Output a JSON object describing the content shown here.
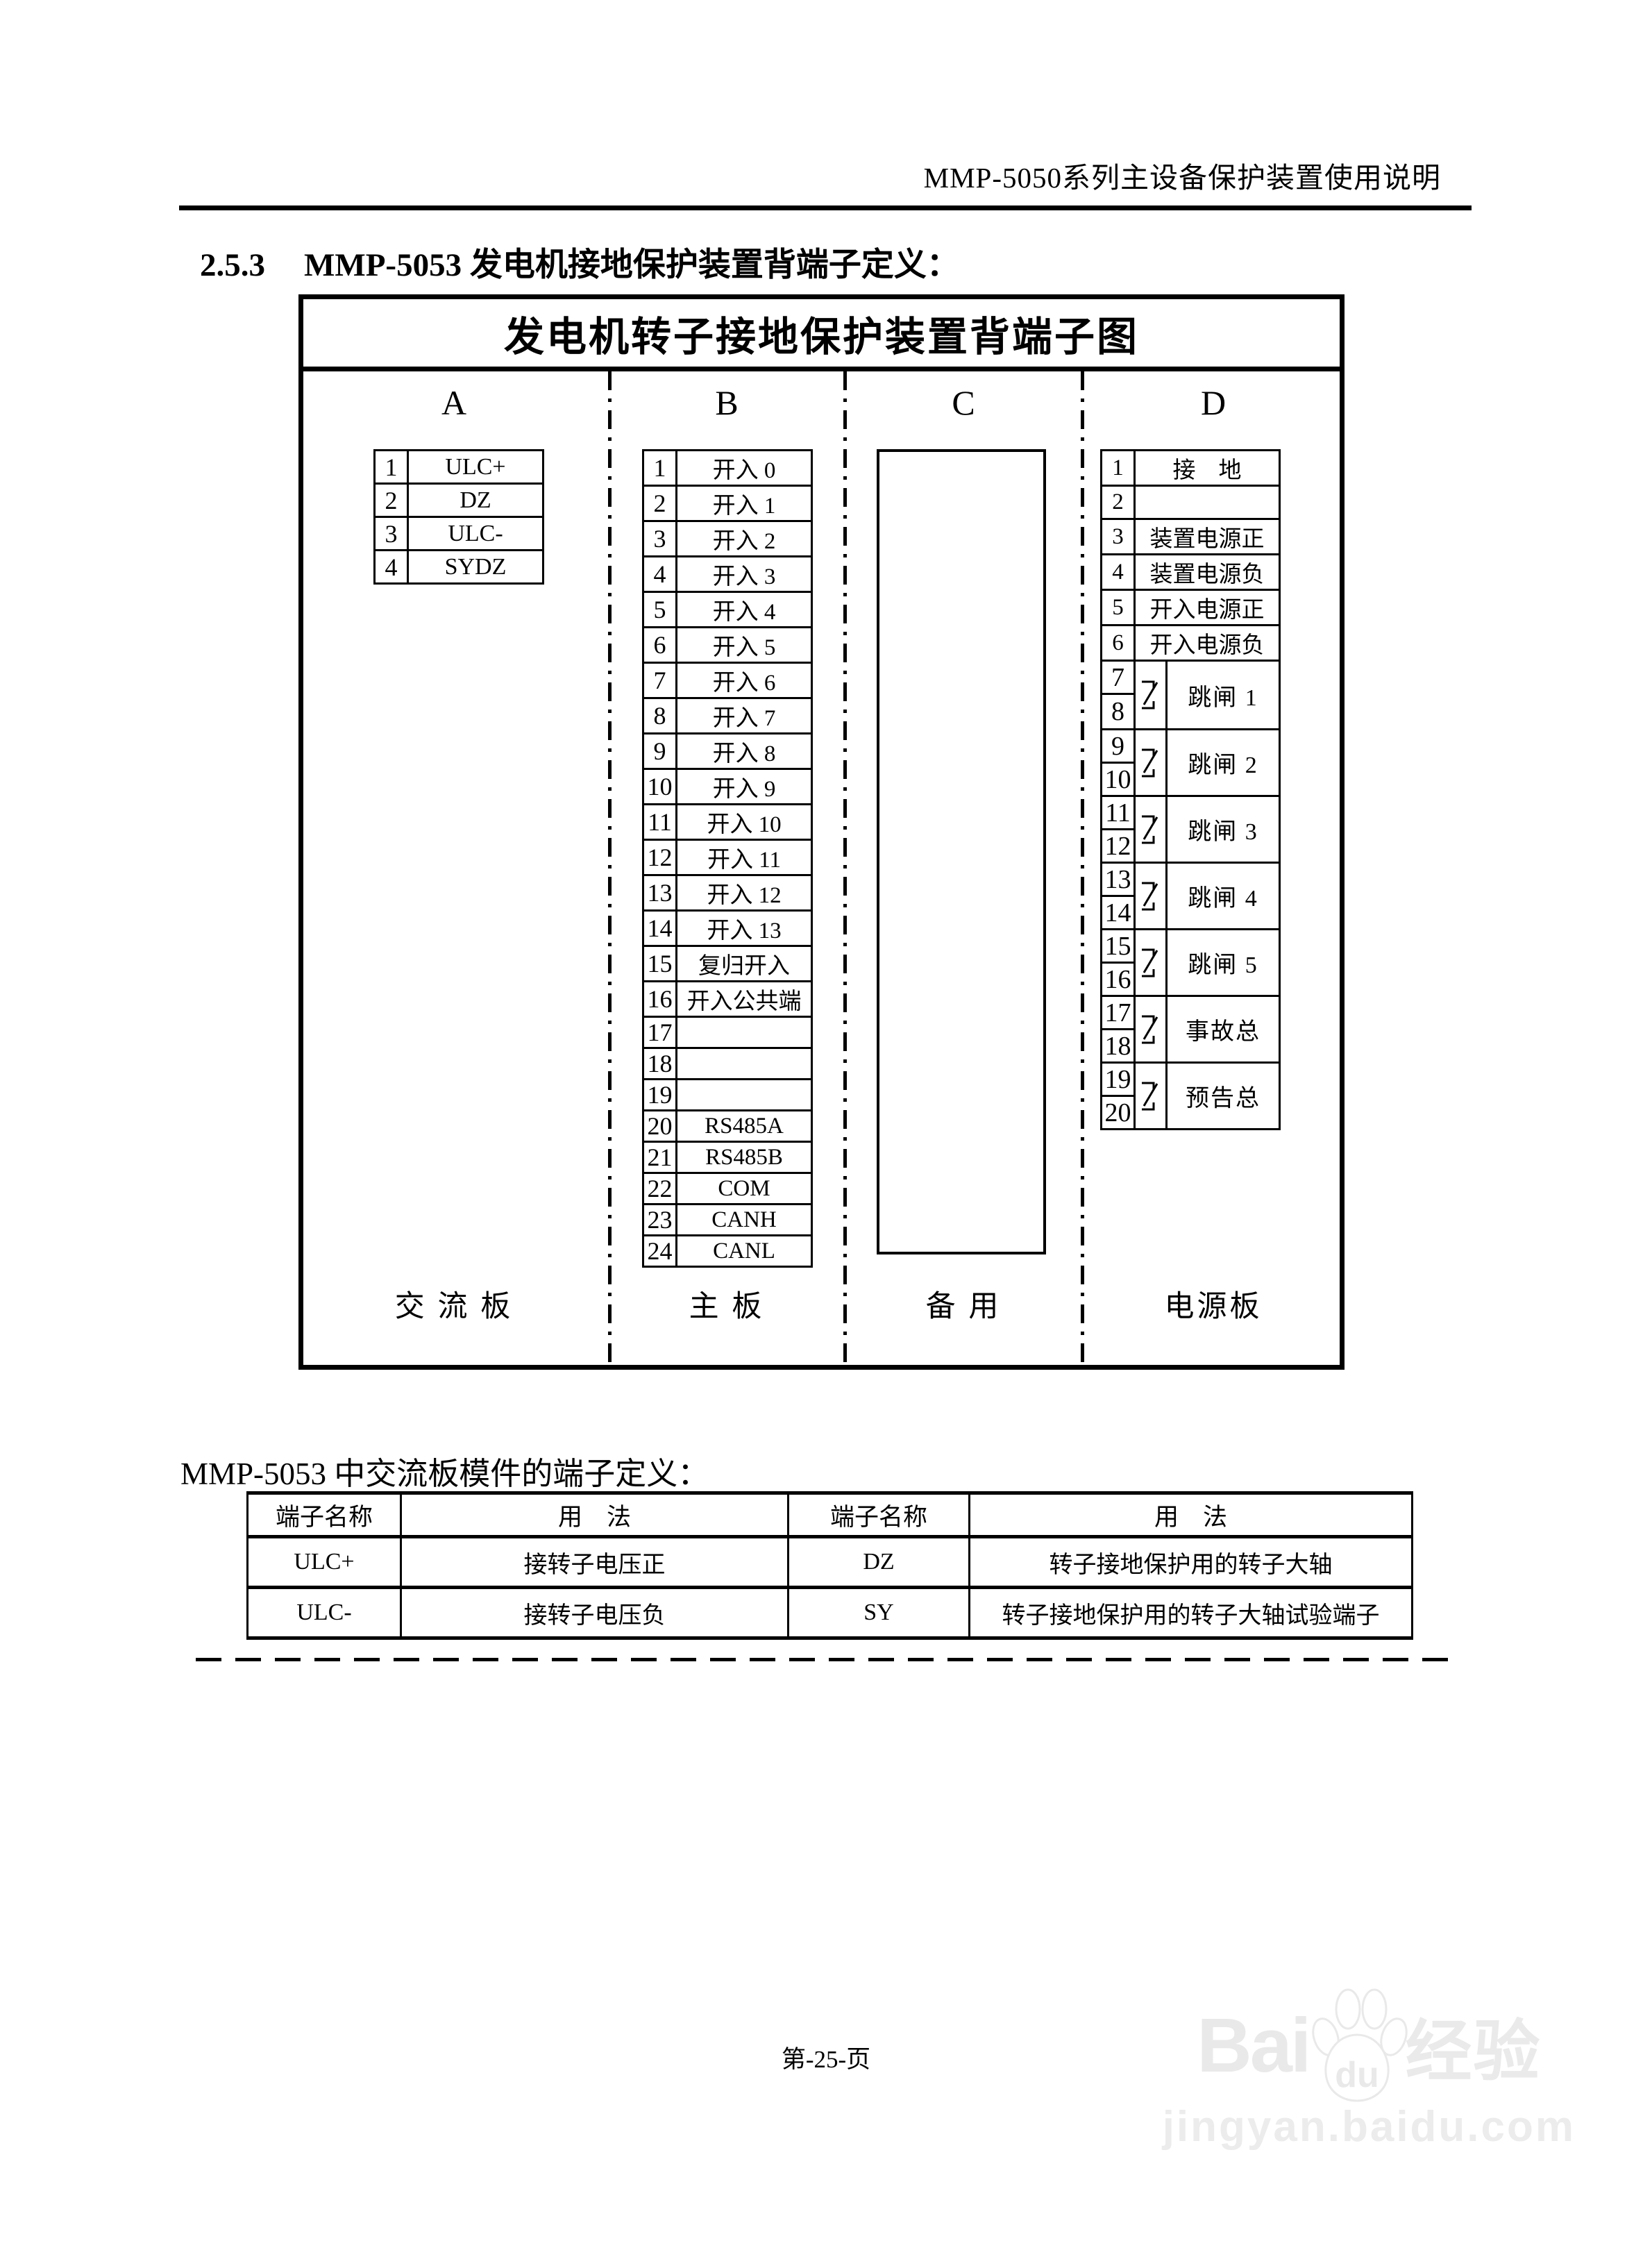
{
  "page": {
    "header": "MMP-5050系列主设备保护装置使用说明",
    "section_number": "2.5.3",
    "section_title": "MMP-5053 发电机接地保护装置背端子定义：",
    "subtitle": "MMP-5053 中交流板模件的端子定义：",
    "page_number": "第-25-页"
  },
  "diagram": {
    "title": "发电机转子接地保护装置背端子图",
    "columns": [
      {
        "letter": "A",
        "board": "交 流 板"
      },
      {
        "letter": "B",
        "board": "主  板"
      },
      {
        "letter": "C",
        "board": "备 用"
      },
      {
        "letter": "D",
        "board": "电源板"
      }
    ],
    "terminals_a": [
      {
        "no": "1",
        "label": "ULC+"
      },
      {
        "no": "2",
        "label": "DZ"
      },
      {
        "no": "3",
        "label": "ULC-"
      },
      {
        "no": "4",
        "label": "SYDZ"
      }
    ],
    "terminals_b": [
      {
        "no": "1",
        "label": "开入 0"
      },
      {
        "no": "2",
        "label": "开入 1"
      },
      {
        "no": "3",
        "label": "开入 2"
      },
      {
        "no": "4",
        "label": "开入 3"
      },
      {
        "no": "5",
        "label": "开入 4"
      },
      {
        "no": "6",
        "label": "开入 5"
      },
      {
        "no": "7",
        "label": "开入 6"
      },
      {
        "no": "8",
        "label": "开入 7"
      },
      {
        "no": "9",
        "label": "开入 8"
      },
      {
        "no": "10",
        "label": "开入 9"
      },
      {
        "no": "11",
        "label": "开入 10"
      },
      {
        "no": "12",
        "label": "开入 11"
      },
      {
        "no": "13",
        "label": "开入 12"
      },
      {
        "no": "14",
        "label": "开入 13"
      },
      {
        "no": "15",
        "label": "复归开入"
      },
      {
        "no": "16",
        "label": "开入公共端"
      },
      {
        "no": "17",
        "label": ""
      },
      {
        "no": "18",
        "label": ""
      },
      {
        "no": "19",
        "label": ""
      },
      {
        "no": "20",
        "label": "RS485A"
      },
      {
        "no": "21",
        "label": "RS485B"
      },
      {
        "no": "22",
        "label": "COM"
      },
      {
        "no": "23",
        "label": "CANH"
      },
      {
        "no": "24",
        "label": "CANL"
      }
    ],
    "terminals_d_singles": [
      {
        "no": "1",
        "label": "接　地"
      },
      {
        "no": "2",
        "label": ""
      },
      {
        "no": "3",
        "label": "装置电源正"
      },
      {
        "no": "4",
        "label": "装置电源负"
      },
      {
        "no": "5",
        "label": "开入电源正"
      },
      {
        "no": "6",
        "label": "开入电源负"
      }
    ],
    "terminals_d_pairs": [
      {
        "top": "7",
        "bottom": "8",
        "label": "跳闸 1"
      },
      {
        "top": "9",
        "bottom": "10",
        "label": "跳闸 2"
      },
      {
        "top": "11",
        "bottom": "12",
        "label": "跳闸 3"
      },
      {
        "top": "13",
        "bottom": "14",
        "label": "跳闸 4"
      },
      {
        "top": "15",
        "bottom": "16",
        "label": "跳闸 5"
      },
      {
        "top": "17",
        "bottom": "18",
        "label": "事故总"
      },
      {
        "top": "19",
        "bottom": "20",
        "label": "预告总"
      }
    ]
  },
  "def_table": {
    "headers": [
      "端子名称",
      "用　法",
      "端子名称",
      "用　法"
    ],
    "rows": [
      [
        "ULC+",
        "接转子电压正",
        "DZ",
        "转子接地保护用的转子大轴"
      ],
      [
        "ULC-",
        "接转子电压负",
        "SY",
        "转子接地保护用的转子大轴试验端子"
      ]
    ]
  },
  "watermark": {
    "brand_left": "Bai",
    "brand_mid": "du",
    "brand_right": "经验",
    "url": "jingyan.baidu.com",
    "color": "#e9e9e9"
  }
}
